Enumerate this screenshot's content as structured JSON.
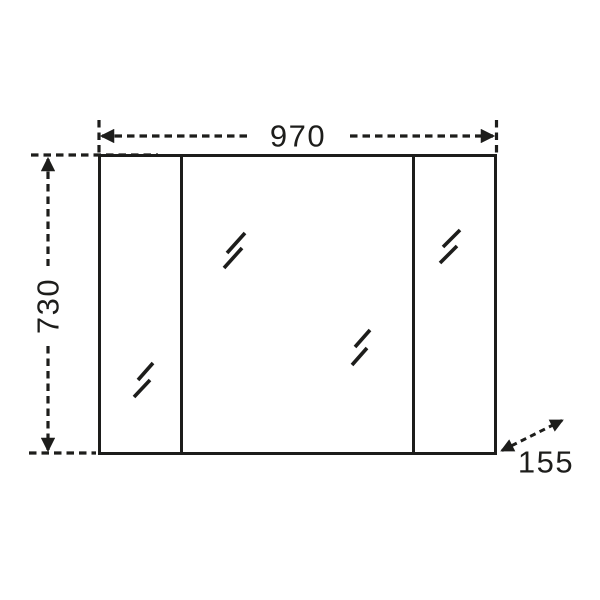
{
  "diagram": {
    "background_color": "#ffffff",
    "line_color": "#1d1d1b",
    "dimensions": {
      "width": {
        "value": 970,
        "label": "970",
        "orientation": "horizontal",
        "position": "top"
      },
      "height": {
        "value": 730,
        "label": "730",
        "orientation": "vertical",
        "position": "left"
      },
      "depth": {
        "value": 155,
        "label": "155",
        "orientation": "diagonal",
        "position": "bottom-right"
      }
    },
    "panels": [
      {
        "name": "left-door",
        "mirror_marks": 1
      },
      {
        "name": "center-door",
        "mirror_marks": 2
      },
      {
        "name": "right-door",
        "mirror_marks": 1
      }
    ]
  }
}
